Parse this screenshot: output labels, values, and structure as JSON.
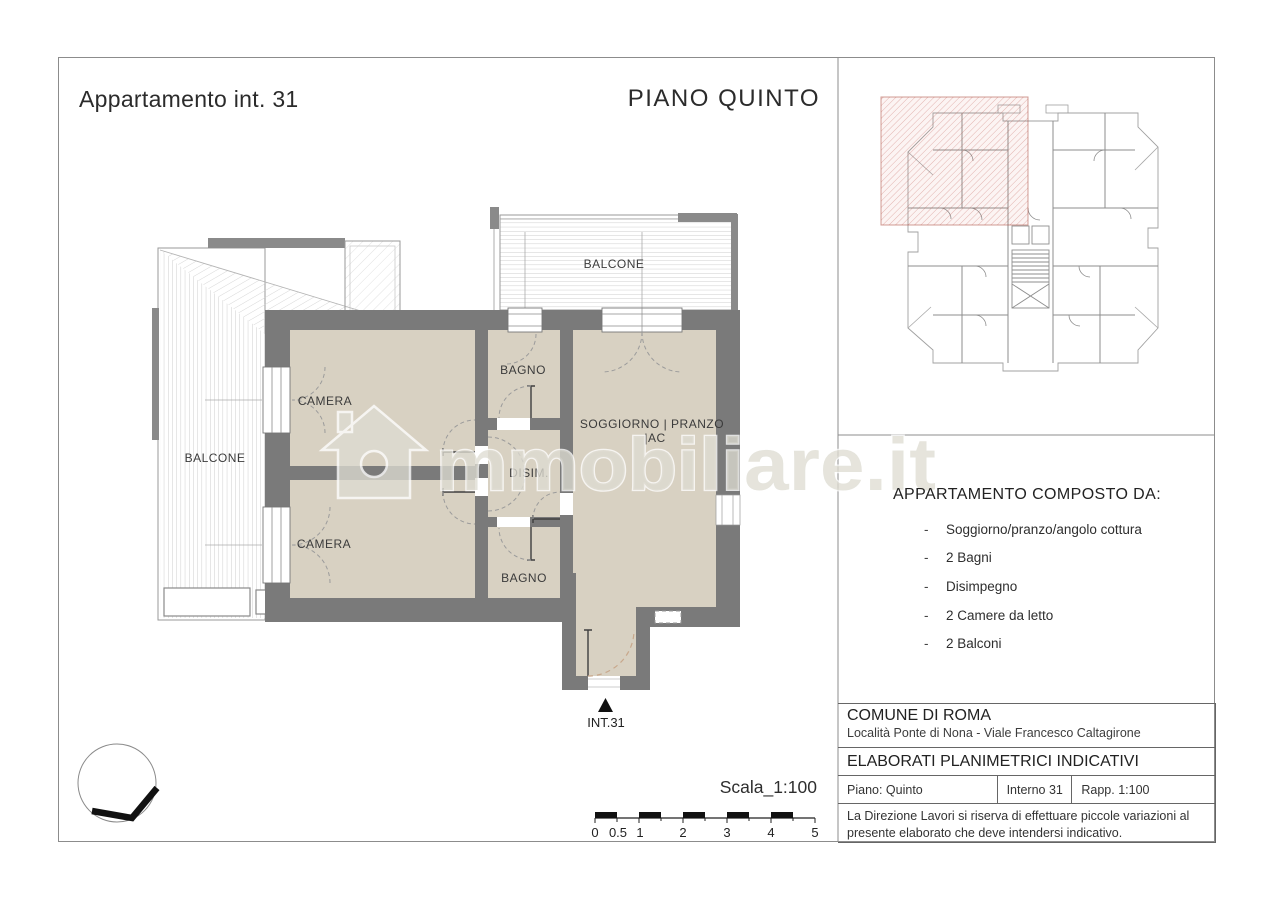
{
  "header": {
    "title": "Appartamento int. 31",
    "floor": "PIANO QUINTO"
  },
  "plan": {
    "labels": {
      "camera_top": "CAMERA",
      "camera_bottom": "CAMERA",
      "bagno_top": "BAGNO",
      "bagno_bottom": "BAGNO",
      "disimpegno": "DISIM.",
      "soggiorno_line1": "SOGGIORNO | PRANZO",
      "soggiorno_line2": "|AC",
      "balcone_left": "BALCONE",
      "balcone_top": "BALCONE",
      "entrance": "INT.31"
    },
    "scale": {
      "label": "Scala_1:100",
      "ticks": [
        "0",
        "0.5",
        "1",
        "2",
        "3",
        "4",
        "5"
      ]
    }
  },
  "watermark": {
    "brand": "immobiliare.it",
    "text_after_icon": "mmobiliare.it"
  },
  "sidebar": {
    "composition": {
      "heading": "APPARTAMENTO COMPOSTO DA:",
      "bullet": "-",
      "items": [
        "Soggiorno/pranzo/angolo cottura",
        "2 Bagni",
        "Disimpegno",
        "2 Camere da letto",
        "2 Balconi"
      ]
    },
    "info": {
      "comune": "COMUNE DI ROMA",
      "localita": "Località Ponte di Nona - Viale Francesco Caltagirone",
      "elaborati": "ELABORATI PLANIMETRICI INDICATIVI",
      "piano": "Piano: Quinto",
      "interno": "Interno 31",
      "rapporto": "Rapp. 1:100",
      "disclaimer": "La Direzione Lavori si riserva di effettuare piccole variazioni al presente elaborato che deve intendersi indicativo."
    }
  },
  "colors": {
    "wall": "#7a7a7a",
    "room_fill": "#d8d1c2",
    "hatch_line": "#c9c9c9",
    "highlight_red": "#b4584b",
    "text": "#2e2e2e"
  }
}
